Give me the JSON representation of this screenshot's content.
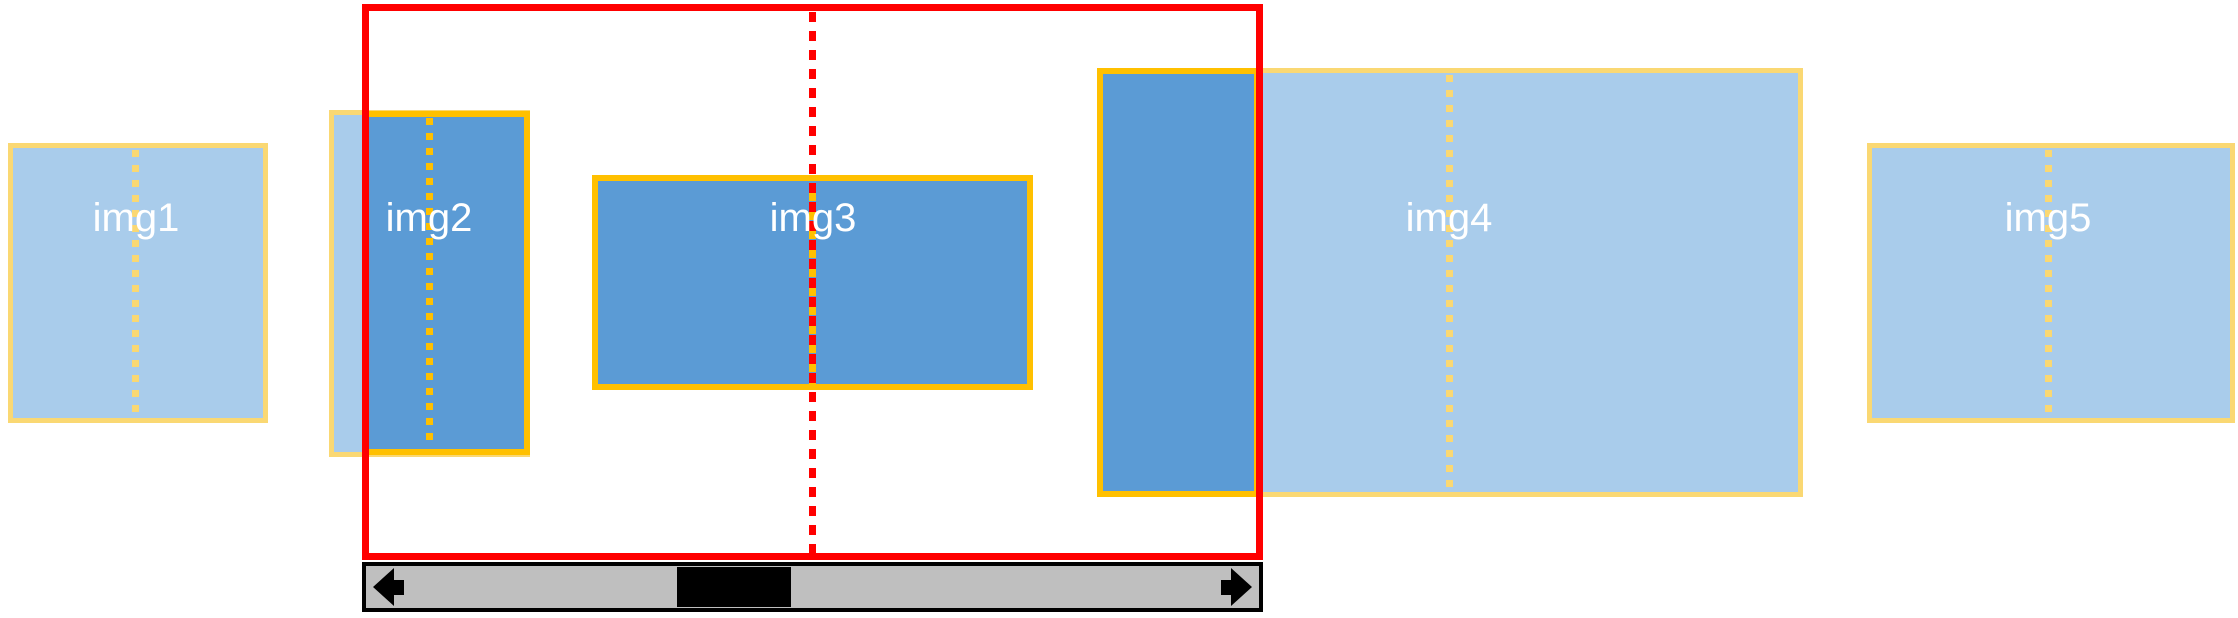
{
  "colors": {
    "canvas_bg": "#FFFFFF",
    "image_fill_full": "#A9CCEB",
    "image_fill_visible": "#5B9BD5",
    "border_full": "#FAD873",
    "border_visible": "#FFC000",
    "viewport_red": "#FF0000",
    "scrollbar_track": "#BFBFBF",
    "scrollbar_black": "#000000",
    "label_text": "#FFFFFF"
  },
  "images": [
    {
      "label": "img1"
    },
    {
      "label": "img2"
    },
    {
      "label": "img3"
    },
    {
      "label": "img4"
    },
    {
      "label": "img5"
    }
  ],
  "scrollbar": {
    "left_arrow_icon": "scroll-left-arrow-icon",
    "right_arrow_icon": "scroll-right-arrow-icon"
  }
}
